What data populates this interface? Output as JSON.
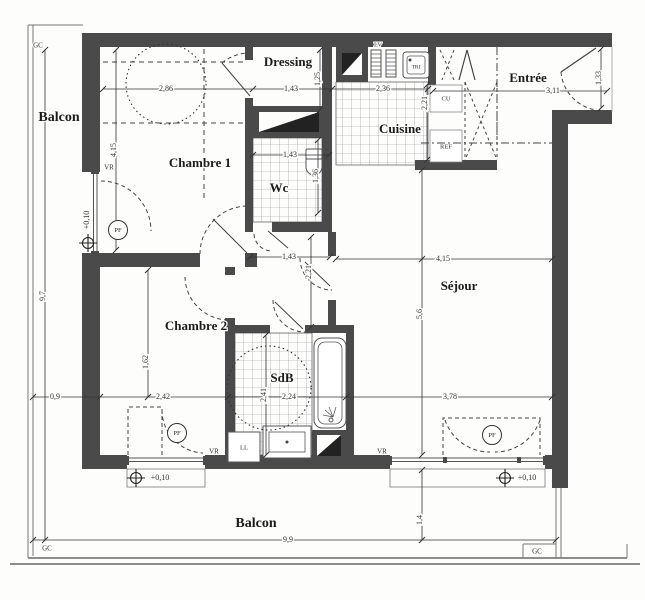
{
  "rooms": {
    "balcon_left": "Balcon",
    "balcon_bottom": "Balcon",
    "chambre1": "Chambre 1",
    "chambre2": "Chambre 2",
    "dressing": "Dressing",
    "wc": "Wc",
    "cuisine": "Cuisine",
    "entree": "Entrée",
    "sejour": "Séjour",
    "sdb": "SdB"
  },
  "fixtures": {
    "cu": "CU",
    "ref": "REF",
    "lv": "LV",
    "tri": "TRI",
    "ll": "LL"
  },
  "annotations": {
    "gc": "GC",
    "vr": "VR",
    "pf": "PF",
    "level": "+0,10"
  },
  "dimensions": {
    "chambre1_width": "2,86",
    "chambre1_depth": "4,15",
    "dressing_width": "1,43",
    "dressing_depth": "1,25",
    "cuisine_width": "2,36",
    "cuisine_depth": "2,21",
    "entree_width": "3,11",
    "entree_depth": "1,33",
    "wc_width": "1,43",
    "wc_depth": "1,36",
    "hall_width": "1,43",
    "hall_depth": "2,21",
    "sejour_width": "4,15",
    "sejour_depth": "5,6",
    "chambre2_width": "2,42",
    "chambre2_depth": "1,62",
    "sdb_width": "2,24",
    "sdb_depth": "2,41",
    "sejour_window_width": "3,78",
    "balcon_left_width": "0,9",
    "balcon_left_length": "9,7",
    "balcon_bottom_length": "9,9",
    "balcon_bottom_depth": "1,4"
  },
  "colors": {
    "wall": "#4a4a4a",
    "line": "#555555",
    "text": "#222222",
    "paper": "#fdfdfc"
  }
}
